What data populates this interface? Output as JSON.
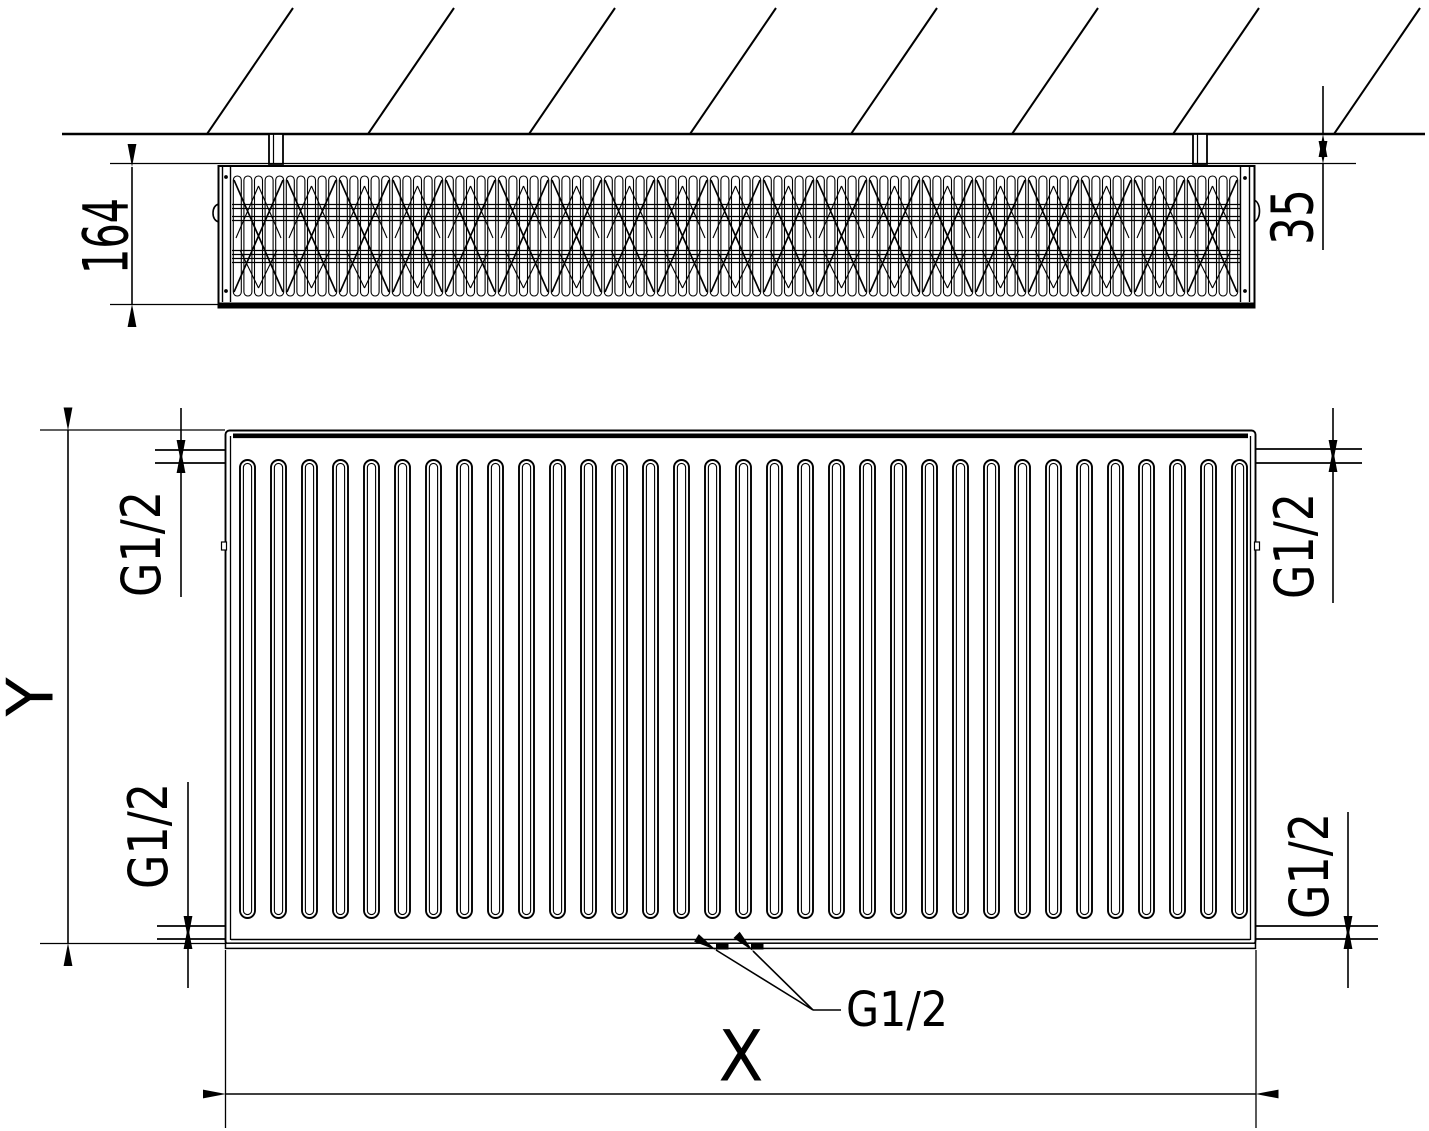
{
  "drawing": {
    "kind": "panel-radiator-dimensional-drawing"
  },
  "top_view": {
    "depth_dimension": "164",
    "wall_clearance_dimension": "35"
  },
  "front_view": {
    "height_dimension": "Y",
    "length_dimension": "X",
    "thread_labels": {
      "top_left": "G1/2",
      "top_right": "G1/2",
      "bottom_left": "G1/2",
      "bottom_right": "G1/2",
      "bottom_center": "G1/2"
    }
  },
  "colors": {
    "line": "#000000",
    "background": "#ffffff",
    "text": "#000000"
  }
}
